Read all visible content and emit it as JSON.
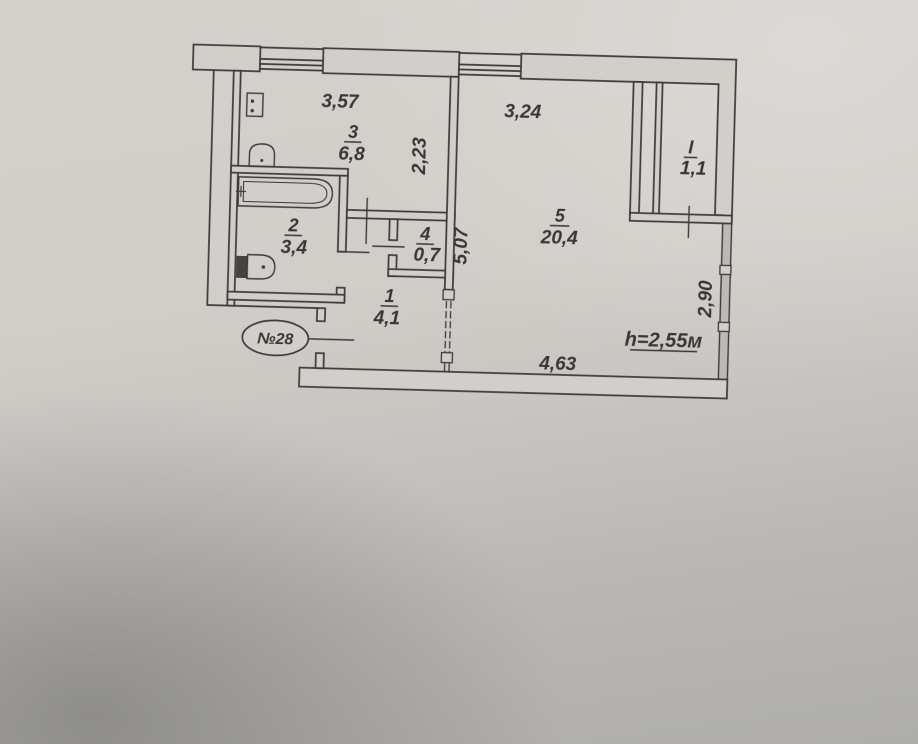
{
  "plan": {
    "title": "apartment floor plan",
    "apartment_number": "№28",
    "ceiling_height": "h=2,55м",
    "rooms": [
      {
        "number": "3",
        "area": "6,8"
      },
      {
        "number": "2",
        "area": "3,4"
      },
      {
        "number": "4",
        "area": "0,7"
      },
      {
        "number": "1",
        "area": "4,1"
      },
      {
        "number": "5",
        "area": "20,4"
      },
      {
        "number": "I",
        "area": "1,1"
      }
    ],
    "dimensions": {
      "kitchen_width": "3,57",
      "room5_top": "3,24",
      "kitchen_depth": "2,23",
      "hall_wall": "5,07",
      "window_wall": "2,90",
      "bottom": "4,63"
    },
    "fixtures": [
      "bathtub",
      "toilet",
      "sink",
      "stove"
    ],
    "colors": {
      "ink": "#3a3733",
      "paper": "#d2cfca",
      "shadow": "#a8a7a4"
    }
  }
}
